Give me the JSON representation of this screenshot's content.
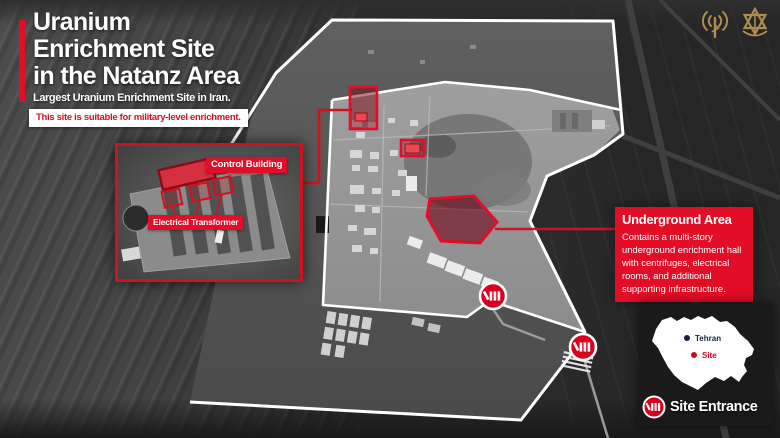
{
  "header": {
    "title_lines": [
      "Uranium",
      "Enrichment Site",
      "in the Natanz Area"
    ],
    "subtitle": "Largest Uranium Enrichment Site in Iran.",
    "banner": "This site is suitable for military-level enrichment."
  },
  "inset": {
    "control_building_label": "Control Building",
    "electrical_transformer_label": "Electrical Transformer"
  },
  "underground": {
    "title": "Underground Area",
    "body_lines": [
      "Contains a multi-story",
      "underground enrichment hall",
      "with centrifuges, electrical",
      "rooms, and additional",
      "supporting infrastructure."
    ]
  },
  "map_legend": {
    "tehran": "Tehran",
    "site": "Site",
    "entrance": "Site Entrance"
  },
  "icons": {
    "top_right": [
      "radio-tower-icon",
      "idf-emblem-icon"
    ],
    "entrance_marker": "gate-icon"
  },
  "colors": {
    "accent_red": "#e20d26",
    "banner_text_red": "#d50f22",
    "marker_red": "#d8001d",
    "boundary_white": "#ffffff",
    "emblem_gold": "#ad8c51",
    "panel_dark": "#1a1a1a",
    "tehran_navy": "#16233c"
  }
}
